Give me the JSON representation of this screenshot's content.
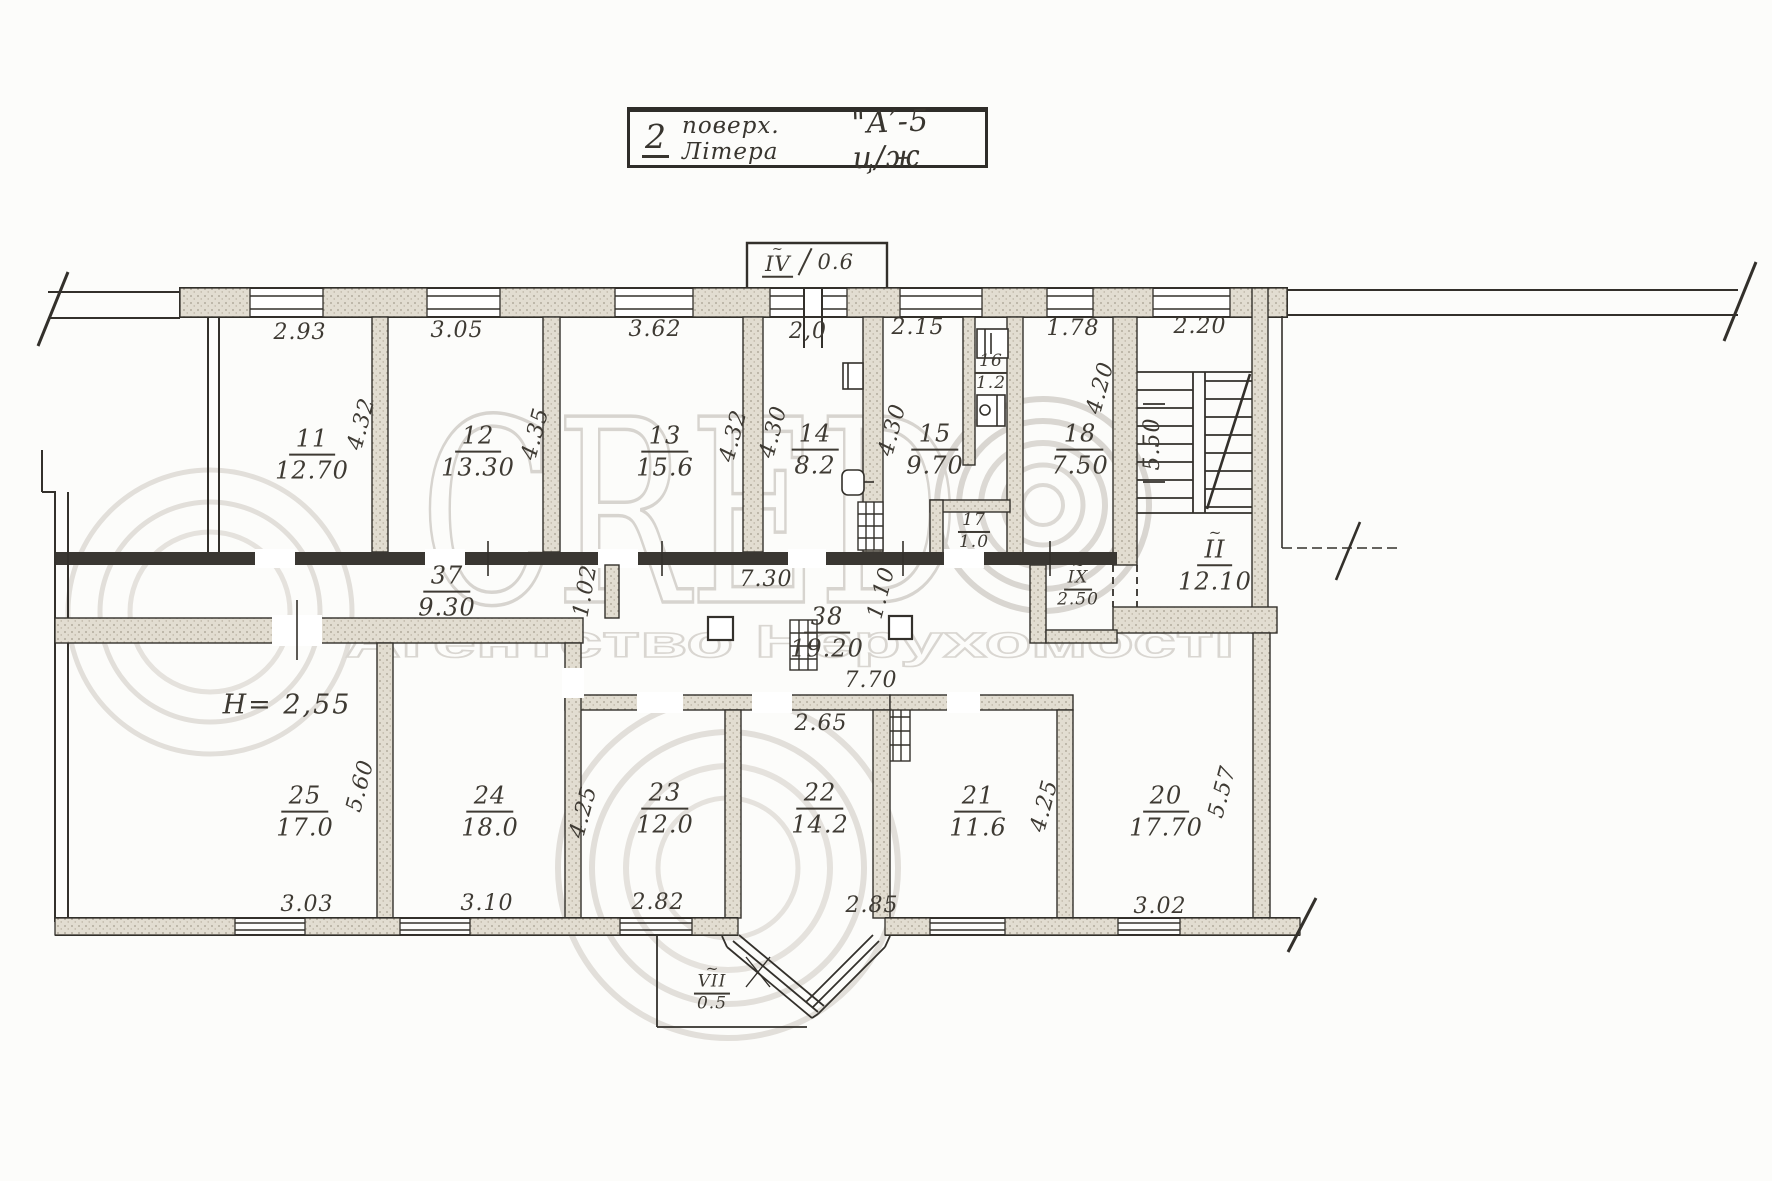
{
  "title_block": {
    "floor_number": "2",
    "caption": "поверх. Літера",
    "block_code": "\"А′-5 ц/ж"
  },
  "watermark": {
    "brand": "CRED",
    "subtitle": "Агентство Нерухомості"
  },
  "approx_mark": "~",
  "top_wing": {
    "balcony": {
      "code": "IV",
      "value": "0.6"
    },
    "rooms": [
      {
        "num": "11",
        "area": "12.70",
        "width": "2.93",
        "depth": "4.32"
      },
      {
        "num": "12",
        "area": "13.30",
        "width": "3.05",
        "depth": "4.35"
      },
      {
        "num": "13",
        "area": "15.6",
        "width": "3.62",
        "depth": "4.32"
      },
      {
        "num": "14",
        "area": "8.2",
        "width": "2,0",
        "depth": "4.30"
      },
      {
        "num": "15",
        "area": "9.70",
        "width": "2.15",
        "depth": "4.30"
      },
      {
        "num": "16",
        "area": "1.2"
      },
      {
        "num": "17",
        "area": "1.0"
      },
      {
        "num": "18",
        "area": "7.50",
        "width": "1.78",
        "depth": "4.20"
      }
    ],
    "stairwell": {
      "width": "2.20",
      "depth": "5.50",
      "code": "II",
      "value": "12.10"
    }
  },
  "corridor": {
    "hall37": {
      "num": "37",
      "area": "9.30"
    },
    "hall38": {
      "num": "38",
      "area": "19.20"
    },
    "dim_length": "7.30",
    "dim_width": "1.02",
    "dim_open": "1.10",
    "dim_38_length": "7.70",
    "lobby": {
      "code": "IX",
      "value": "2.50"
    }
  },
  "bottom_wing": {
    "ceiling_height": "H= 2,55",
    "rooms": [
      {
        "num": "25",
        "area": "17.0",
        "width": "3.03",
        "depth": "5.60"
      },
      {
        "num": "24",
        "area": "18.0",
        "width": "3.10"
      },
      {
        "num": "23",
        "area": "12.0",
        "width": "2.82",
        "depth": "4.25"
      },
      {
        "num": "22",
        "area": "14.2",
        "width": "2.65"
      },
      {
        "num": "21",
        "area": "11.6",
        "width": "2.85",
        "depth": "4.25"
      },
      {
        "num": "20",
        "area": "17.70",
        "width": "3.02",
        "depth": "5.57"
      }
    ],
    "bay": {
      "code": "VII",
      "value": "0.5"
    }
  }
}
